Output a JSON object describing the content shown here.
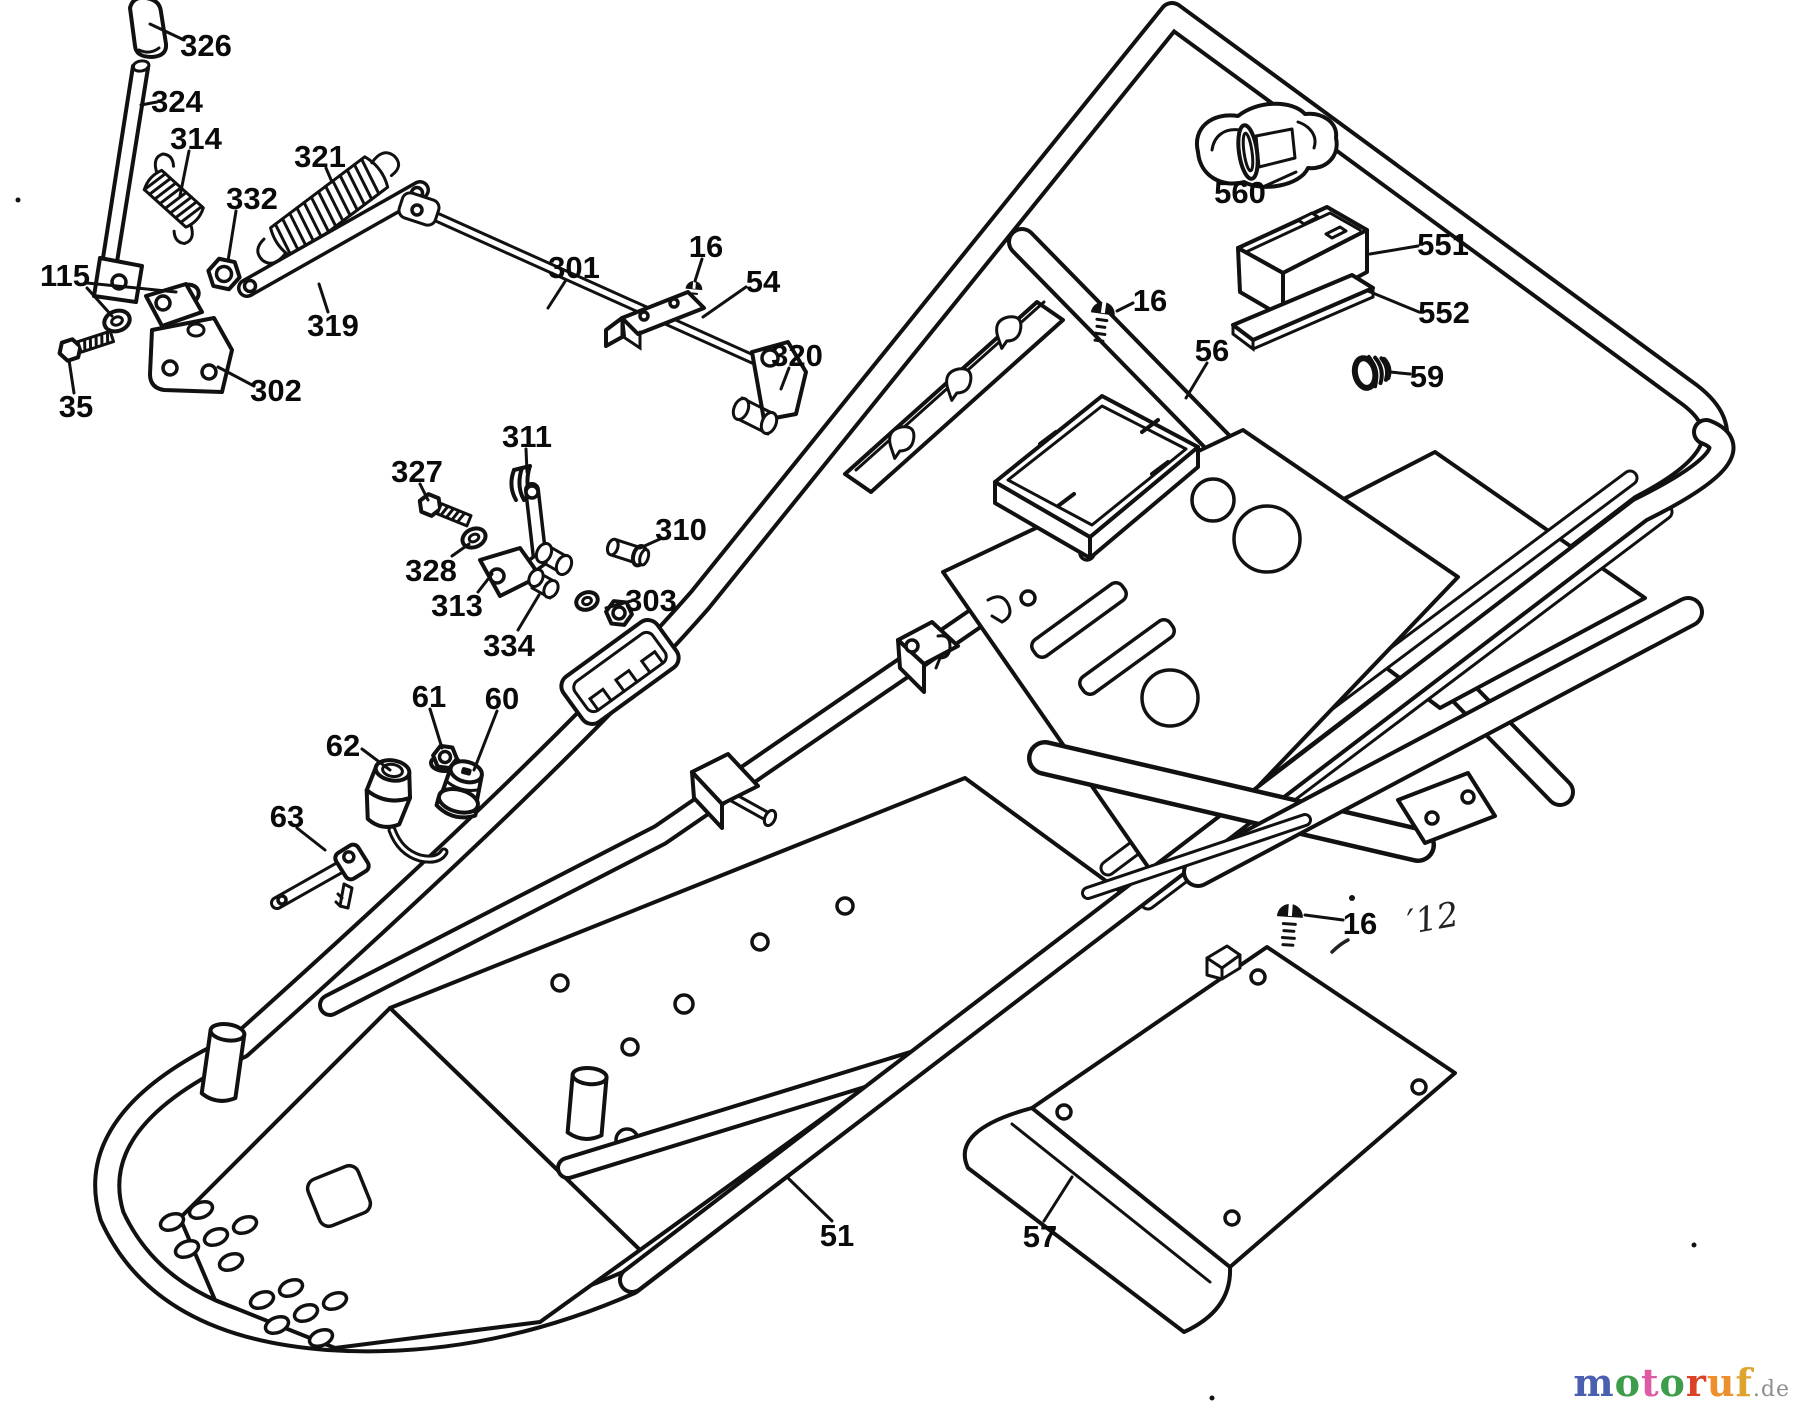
{
  "diagram": {
    "type": "exploded-parts-diagram",
    "subject": "frame assembly line drawing",
    "background_color": "#ffffff",
    "line_color": "#111111",
    "label_color": "#0a0a0a",
    "labels": [
      {
        "id": "326",
        "text": "326",
        "x": 206,
        "y": 45,
        "leaders": [
          [
            [
              184,
              40
            ],
            [
              150,
              24
            ]
          ]
        ]
      },
      {
        "id": "324",
        "text": "324",
        "x": 177,
        "y": 101,
        "leaders": [
          [
            [
              157,
              102
            ],
            [
              141,
              105
            ]
          ]
        ]
      },
      {
        "id": "314",
        "text": "314",
        "x": 196,
        "y": 138,
        "leaders": [
          [
            [
              189,
              151
            ],
            [
              180,
              196
            ]
          ]
        ]
      },
      {
        "id": "332",
        "text": "332",
        "x": 252,
        "y": 198,
        "leaders": [
          [
            [
              236,
              211
            ],
            [
              228,
              261
            ]
          ]
        ]
      },
      {
        "id": "321",
        "text": "321",
        "x": 320,
        "y": 156,
        "leaders": [
          [
            [
              326,
              168
            ],
            [
              332,
              182
            ]
          ]
        ]
      },
      {
        "id": "319",
        "text": "319",
        "x": 333,
        "y": 325,
        "leaders": [
          [
            [
              328,
              312
            ],
            [
              319,
              284
            ]
          ]
        ]
      },
      {
        "id": "115",
        "text": "115",
        "x": 65,
        "y": 275,
        "leaders": [
          [
            [
              87,
              283
            ],
            [
              176,
              292
            ]
          ],
          [
            [
              87,
              288
            ],
            [
              112,
              316
            ]
          ]
        ]
      },
      {
        "id": "35",
        "text": "35",
        "x": 76,
        "y": 406,
        "leaders": [
          [
            [
              74,
              393
            ],
            [
              69,
              360
            ]
          ]
        ]
      },
      {
        "id": "302",
        "text": "302",
        "x": 276,
        "y": 390,
        "leaders": [
          [
            [
              254,
              386
            ],
            [
              218,
              367
            ]
          ]
        ]
      },
      {
        "id": "301",
        "text": "301",
        "x": 574,
        "y": 267,
        "leaders": [
          [
            [
              566,
              280
            ],
            [
              548,
              308
            ]
          ]
        ]
      },
      {
        "id": "16a",
        "text": "16",
        "x": 706,
        "y": 246,
        "leaders": [
          [
            [
              702,
              259
            ],
            [
              695,
              281
            ]
          ]
        ]
      },
      {
        "id": "54",
        "text": "54",
        "x": 763,
        "y": 281,
        "leaders": [
          [
            [
              746,
              287
            ],
            [
              703,
              317
            ]
          ]
        ]
      },
      {
        "id": "320",
        "text": "320",
        "x": 797,
        "y": 355,
        "leaders": [
          [
            [
              789,
              368
            ],
            [
              781,
              389
            ]
          ]
        ]
      },
      {
        "id": "311",
        "text": "311",
        "x": 527,
        "y": 436,
        "leaders": [
          [
            [
              526,
              449
            ],
            [
              527,
              472
            ]
          ]
        ]
      },
      {
        "id": "327",
        "text": "327",
        "x": 417,
        "y": 471,
        "leaders": [
          [
            [
              420,
              484
            ],
            [
              428,
              500
            ]
          ]
        ]
      },
      {
        "id": "328",
        "text": "328",
        "x": 431,
        "y": 570,
        "leaders": [
          [
            [
              452,
              556
            ],
            [
              469,
              544
            ]
          ]
        ]
      },
      {
        "id": "313",
        "text": "313",
        "x": 457,
        "y": 605,
        "leaders": [
          [
            [
              478,
              592
            ],
            [
              492,
              574
            ]
          ]
        ]
      },
      {
        "id": "334",
        "text": "334",
        "x": 509,
        "y": 645,
        "leaders": [
          [
            [
              518,
              630
            ],
            [
              539,
              595
            ]
          ]
        ]
      },
      {
        "id": "303",
        "text": "303",
        "x": 651,
        "y": 600,
        "leaders": [
          [
            [
              631,
              601
            ],
            [
              606,
              608
            ]
          ]
        ]
      },
      {
        "id": "310",
        "text": "310",
        "x": 681,
        "y": 529,
        "leaders": [
          [
            [
              660,
              539
            ],
            [
              640,
              548
            ]
          ]
        ]
      },
      {
        "id": "61",
        "text": "61",
        "x": 429,
        "y": 696,
        "leaders": [
          [
            [
              430,
              709
            ],
            [
              442,
              748
            ]
          ]
        ]
      },
      {
        "id": "60",
        "text": "60",
        "x": 502,
        "y": 698,
        "leaders": [
          [
            [
              497,
              711
            ],
            [
              474,
              770
            ]
          ]
        ]
      },
      {
        "id": "62",
        "text": "62",
        "x": 343,
        "y": 745,
        "leaders": [
          [
            [
              362,
              749
            ],
            [
              390,
              770
            ]
          ]
        ]
      },
      {
        "id": "63",
        "text": "63",
        "x": 287,
        "y": 816,
        "leaders": [
          [
            [
              297,
              828
            ],
            [
              325,
              850
            ]
          ]
        ]
      },
      {
        "id": "560",
        "text": "560",
        "x": 1240,
        "y": 192,
        "leaders": [
          [
            [
              1265,
              186
            ],
            [
              1296,
              172
            ]
          ]
        ]
      },
      {
        "id": "551",
        "text": "551",
        "x": 1443,
        "y": 244,
        "leaders": [
          [
            [
              1418,
              246
            ],
            [
              1370,
              254
            ]
          ]
        ]
      },
      {
        "id": "552",
        "text": "552",
        "x": 1444,
        "y": 312,
        "leaders": [
          [
            [
              1419,
              312
            ],
            [
              1368,
              291
            ]
          ]
        ]
      },
      {
        "id": "16b",
        "text": "16",
        "x": 1150,
        "y": 300,
        "leaders": [
          [
            [
              1133,
              303
            ],
            [
              1117,
              311
            ]
          ]
        ]
      },
      {
        "id": "56",
        "text": "56",
        "x": 1212,
        "y": 350,
        "leaders": [
          [
            [
              1207,
              363
            ],
            [
              1186,
              398
            ]
          ]
        ]
      },
      {
        "id": "59",
        "text": "59",
        "x": 1427,
        "y": 376,
        "leaders": [
          [
            [
              1410,
              374
            ],
            [
              1390,
              372
            ]
          ]
        ]
      },
      {
        "id": "16c",
        "text": "16",
        "x": 1360,
        "y": 923,
        "leaders": [
          [
            [
              1343,
              920
            ],
            [
              1305,
              915
            ]
          ]
        ]
      },
      {
        "id": "57",
        "text": "57",
        "x": 1040,
        "y": 1236,
        "leaders": [
          [
            [
              1044,
              1221
            ],
            [
              1072,
              1177
            ]
          ]
        ]
      },
      {
        "id": "51",
        "text": "51",
        "x": 837,
        "y": 1235,
        "leaders": [
          [
            [
              832,
              1221
            ],
            [
              789,
              1179
            ]
          ]
        ]
      }
    ],
    "handwritten_annotation": {
      "text": "′12",
      "x": 1408,
      "y": 922,
      "rotation": -10
    },
    "watermark": {
      "letters": [
        {
          "ch": "m",
          "color": "#4a5fb0"
        },
        {
          "ch": "o",
          "color": "#3d9d4b"
        },
        {
          "ch": "t",
          "color": "#df5aa4"
        },
        {
          "ch": "o",
          "color": "#3d9d4b"
        },
        {
          "ch": "r",
          "color": "#da4327"
        },
        {
          "ch": "u",
          "color": "#ec8f2d"
        },
        {
          "ch": "f",
          "color": "#dfa42e"
        }
      ],
      "suffix": ".de",
      "suffix_color": "#8e8e8e"
    }
  }
}
